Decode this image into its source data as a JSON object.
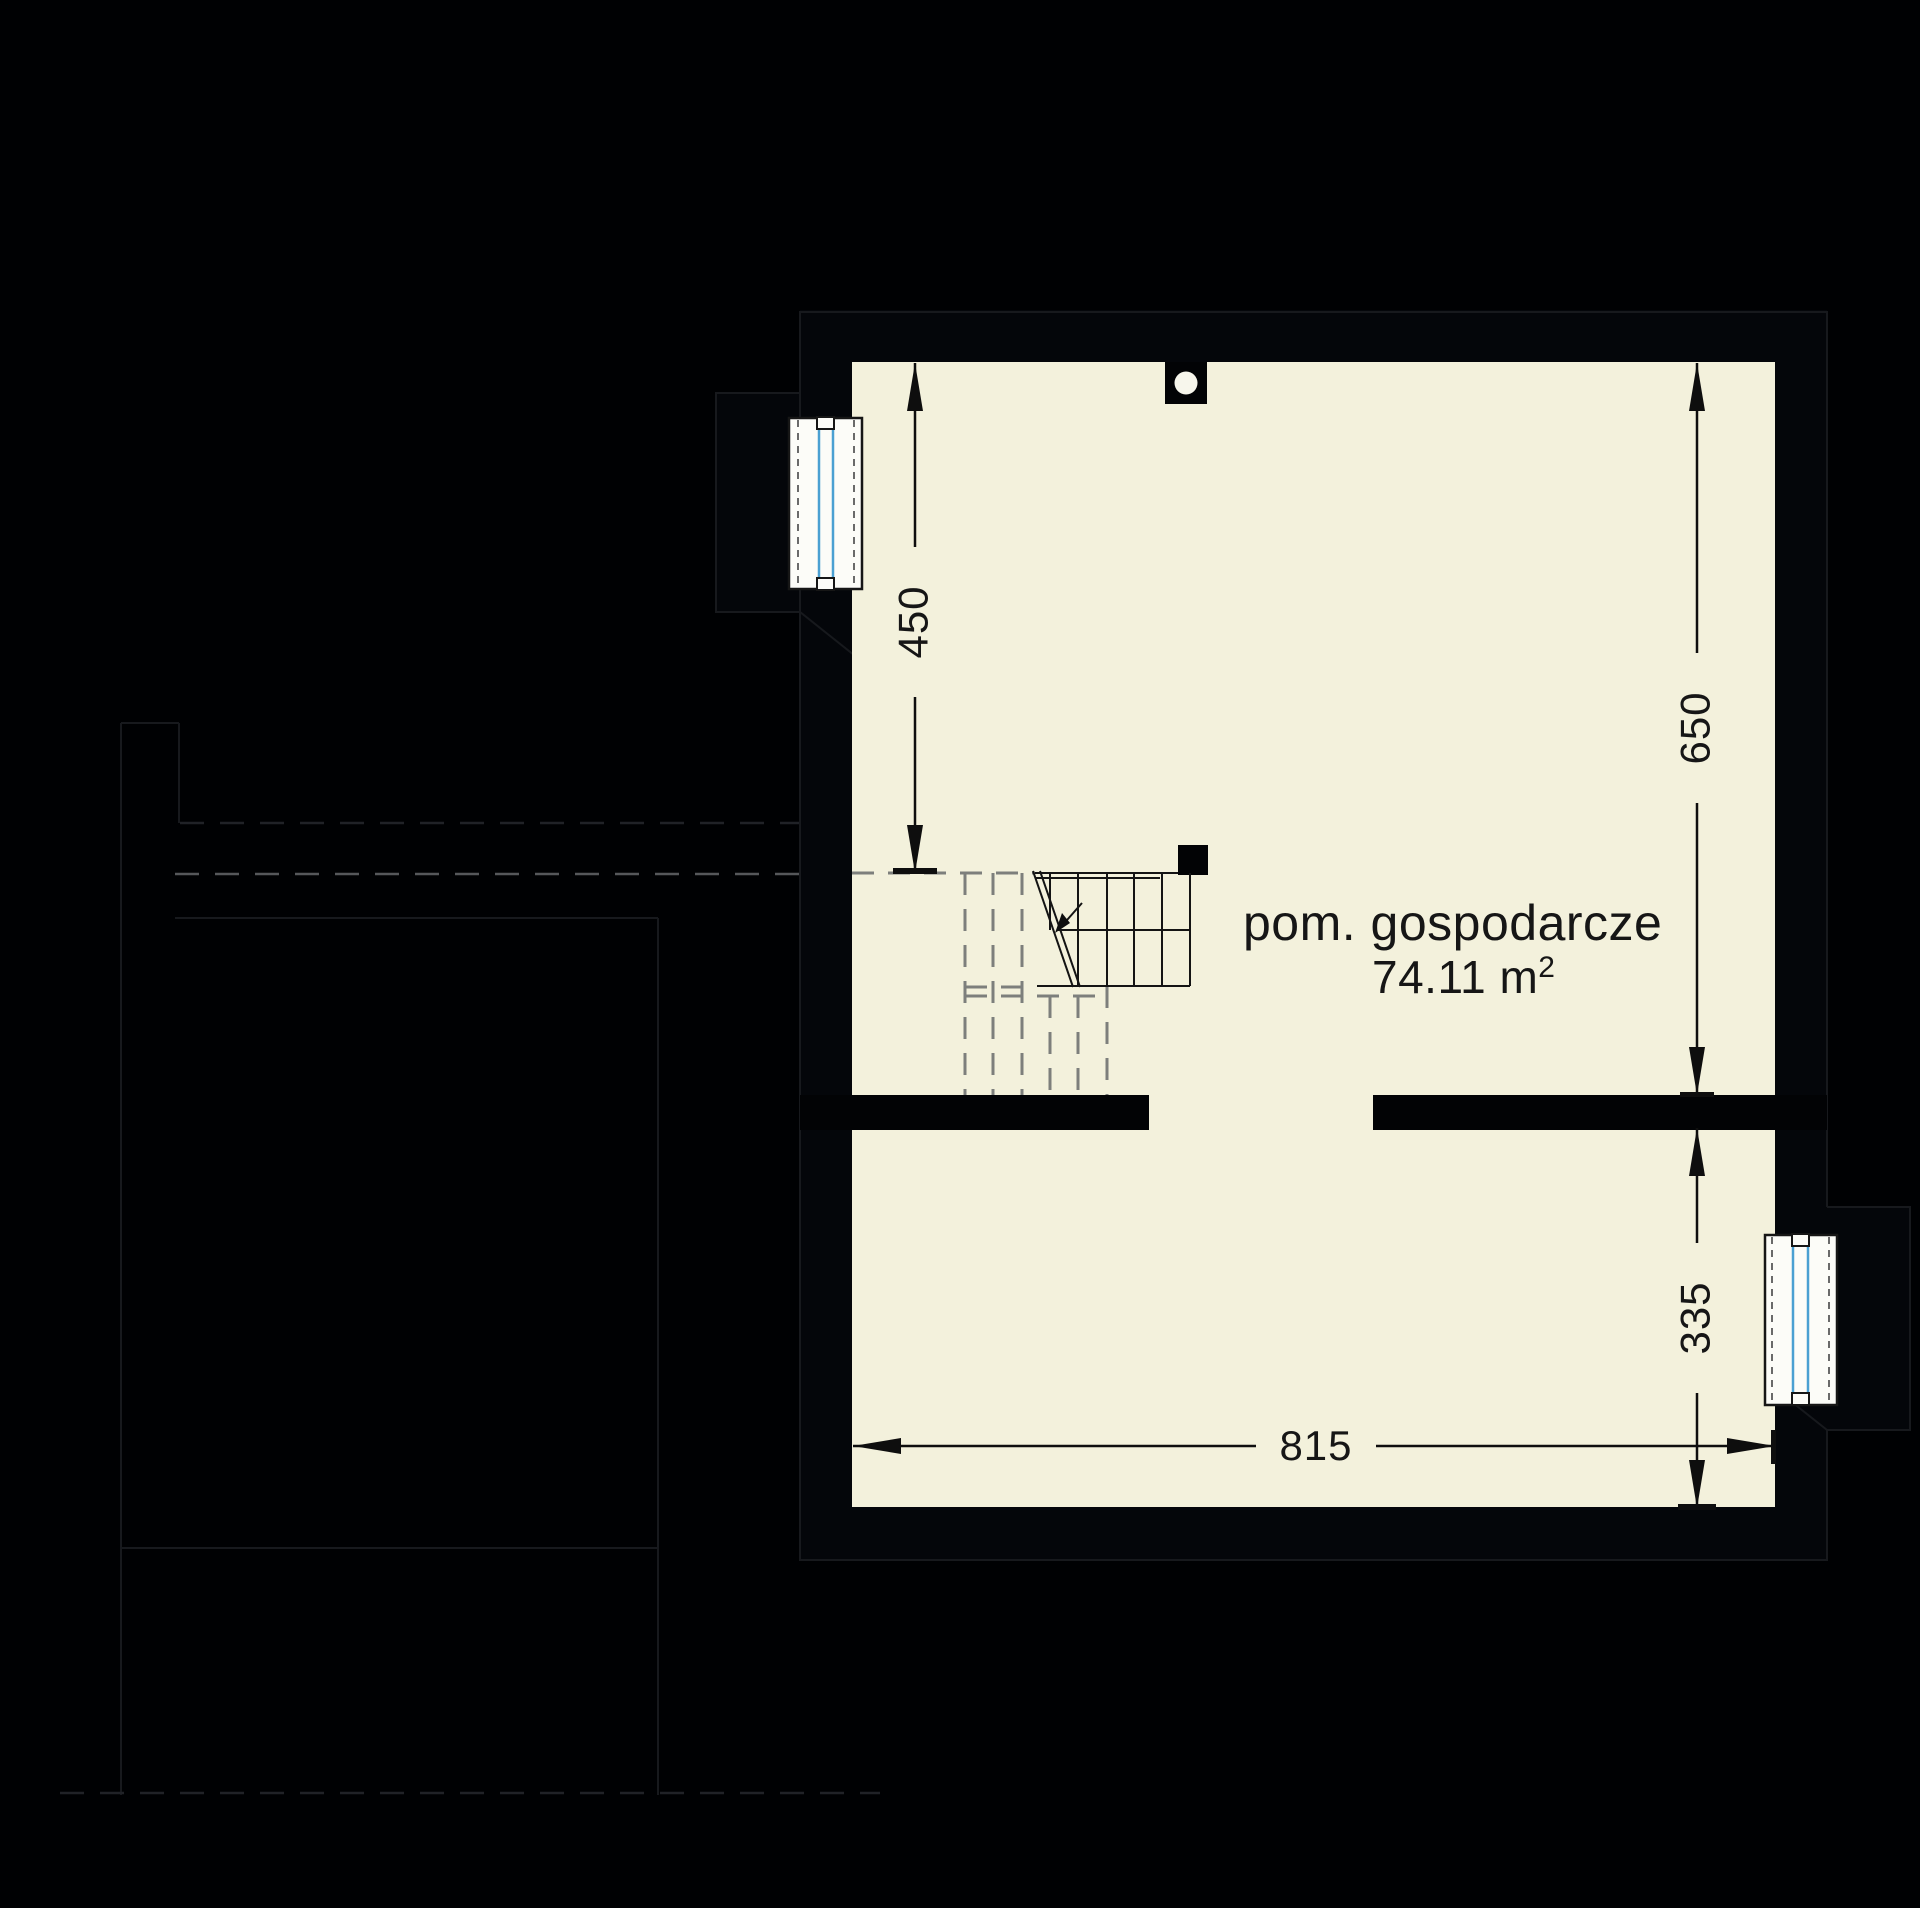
{
  "colors": {
    "background": "#000103",
    "wall": "#04060a",
    "ghost": "#17191d",
    "ghost_dash": "#55575a",
    "floor": "#f3f1dc",
    "window_frame": "#fcfcf8",
    "glazing_blue": "#4aa0d2",
    "dash_gray": "#7d7f7c",
    "line_dark": "#141414",
    "text": "#161616"
  },
  "room": {
    "name": "pom. gospodarcze",
    "area_label": "74.11 m²",
    "area_main": "74.11 m",
    "area_sup": "2"
  },
  "dimensions": {
    "left_height": "450",
    "right_height": "650",
    "right_lower_height": "335",
    "bottom_width": "815"
  }
}
